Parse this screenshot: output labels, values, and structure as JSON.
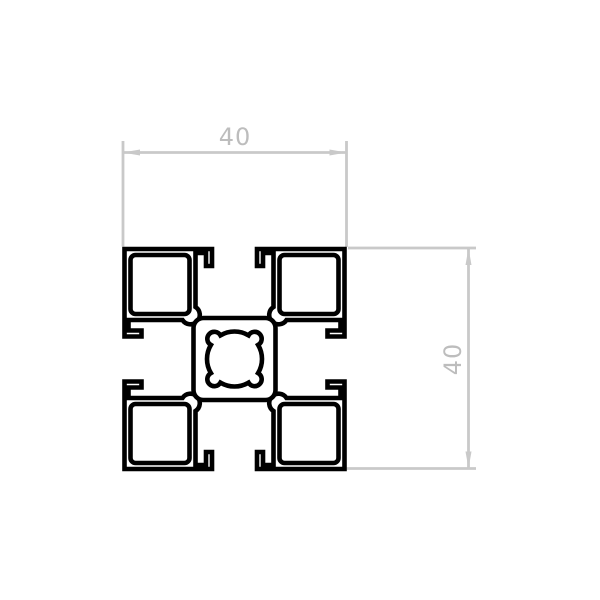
{
  "drawing": {
    "dimensions": {
      "width": {
        "label": "40"
      },
      "height": {
        "label": "40"
      }
    },
    "colors": {
      "dimension_line": "#c9c9c9",
      "dimension_text": "#bdbdbd",
      "profile_stroke": "#000000",
      "background": "#ffffff"
    }
  }
}
